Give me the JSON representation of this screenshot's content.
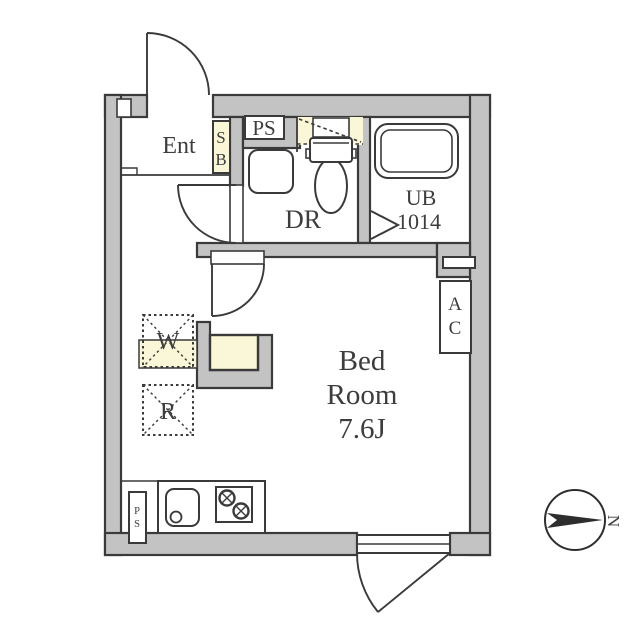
{
  "labels": {
    "entrance": "Ent",
    "shoe_box": [
      "S",
      "B"
    ],
    "pipe_shaft_top": "PS",
    "dressing_room": "DR",
    "unit_bath": [
      "UB",
      "1014"
    ],
    "bedroom": [
      "Bed",
      "Room",
      "7.6J"
    ],
    "air_conditioner": [
      "A",
      "C"
    ],
    "washing_machine": "W",
    "refrigerator": "R",
    "pipe_shaft_kitchen": [
      "P",
      "S"
    ],
    "compass_north": "N"
  },
  "colors": {
    "wall_fill": "#c3c3c3",
    "outline": "#3a3a3a",
    "accent_cream": "#faf6d8",
    "background": "#ffffff",
    "text": "#3d3d3d"
  }
}
